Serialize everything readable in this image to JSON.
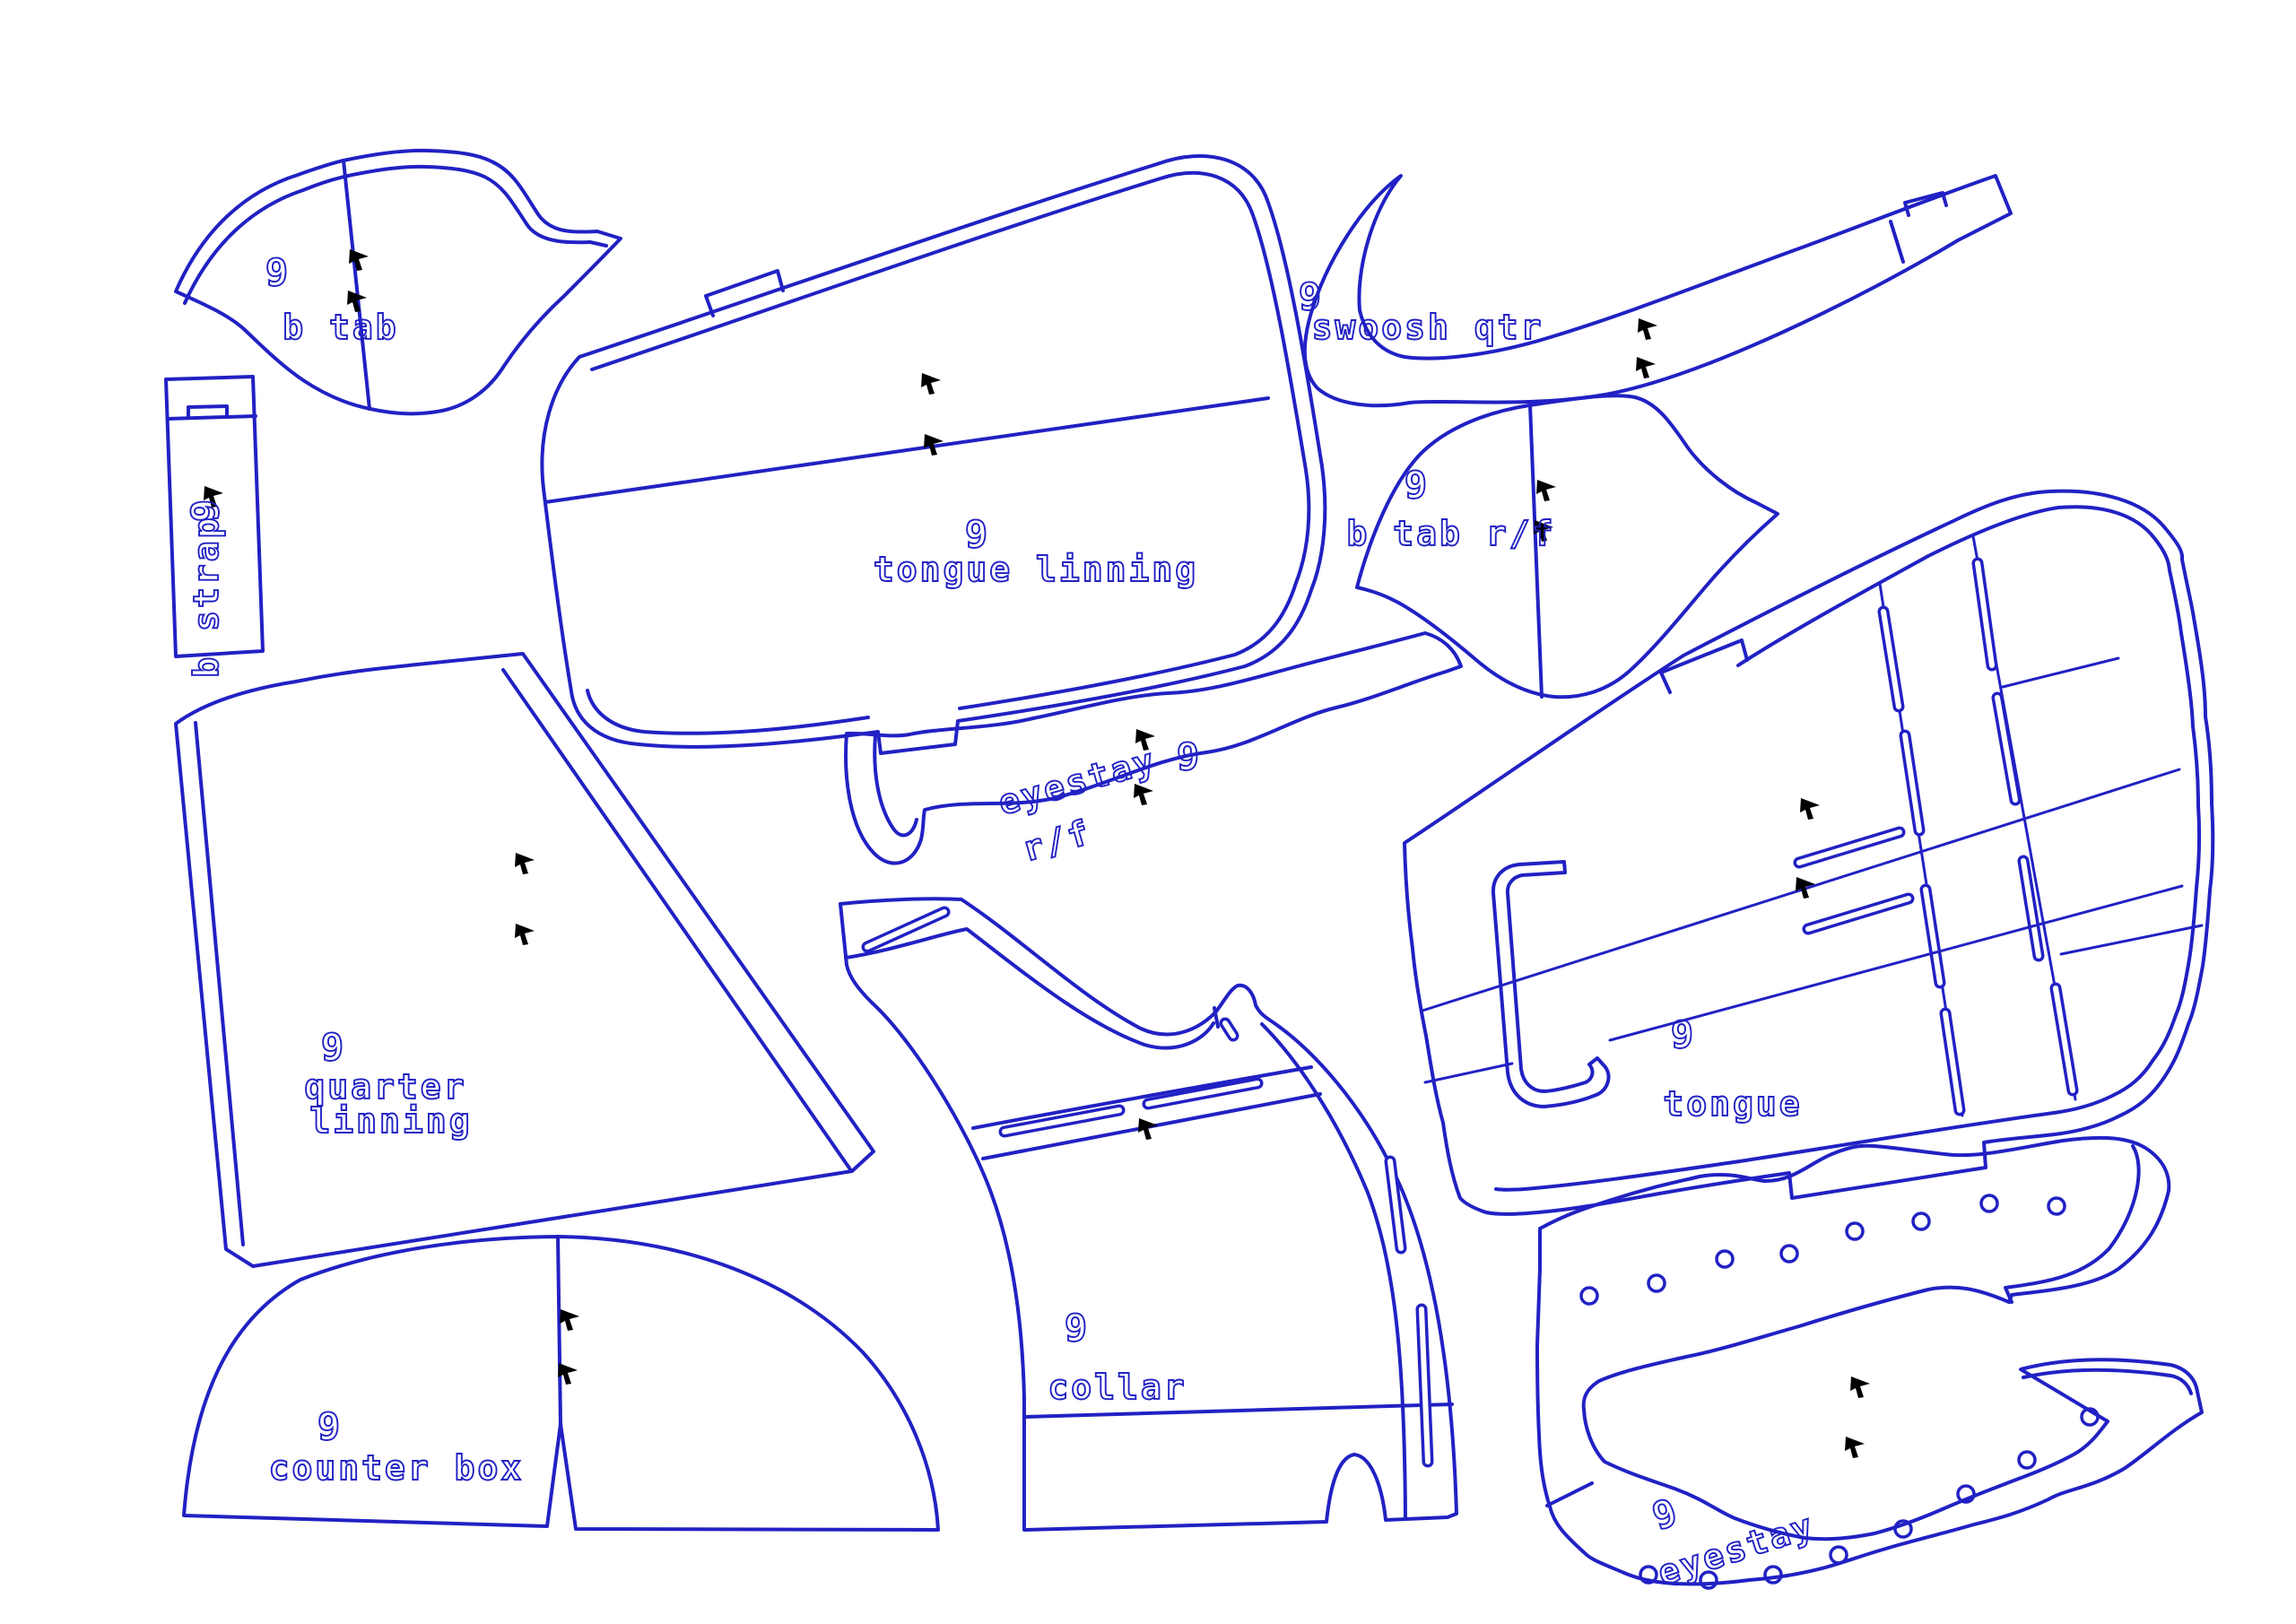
{
  "document": {
    "type": "footwear pattern cad layout",
    "background_color": "#ffffff",
    "line_color": "#2121c4",
    "punch_mark_color": "#000000"
  },
  "pieces": [
    {
      "id": "b-tab",
      "size": "9",
      "label": "b tab"
    },
    {
      "id": "b-strap",
      "size": "9",
      "label": "b strap"
    },
    {
      "id": "tongue-linning",
      "size": "9",
      "label": "tongue linning"
    },
    {
      "id": "swoosh-qtr",
      "size": "9",
      "label": "swoosh qtr"
    },
    {
      "id": "b-tab-rf",
      "size": "9",
      "label": "b tab r/f"
    },
    {
      "id": "eyestay-rf",
      "size": "9",
      "label": "eyestay",
      "label2": "r/f"
    },
    {
      "id": "tongue",
      "size": "9",
      "label": "tongue"
    },
    {
      "id": "quarter-linning",
      "size": "9",
      "label": "quarter",
      "label2": "linning"
    },
    {
      "id": "collar",
      "size": "9",
      "label": "collar"
    },
    {
      "id": "counter-box",
      "size": "9",
      "label": "counter box"
    },
    {
      "id": "eyestay",
      "size": "9",
      "label": "eyestay"
    }
  ]
}
